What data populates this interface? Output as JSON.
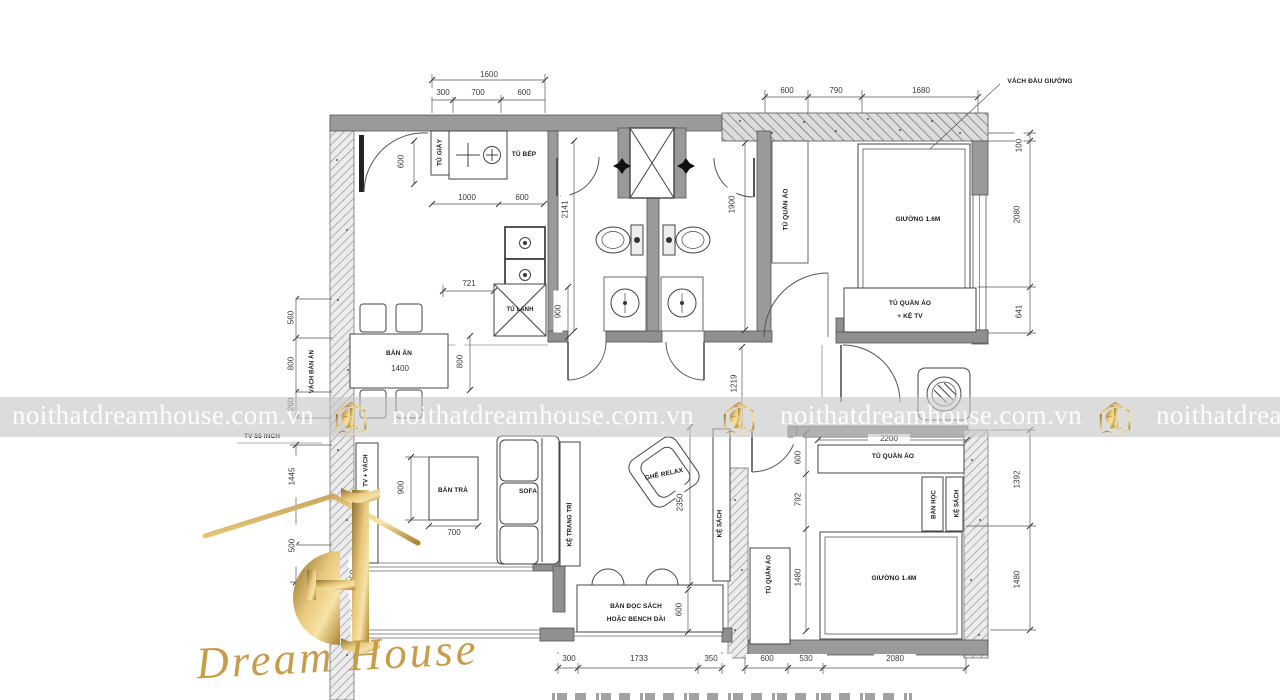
{
  "watermark": {
    "text": "noithatdreamhouse.com.vn",
    "text_partial": "noithatdrea"
  },
  "logo": {
    "title_script": "Dream House"
  },
  "labels": {
    "tu_giay": "TỦ GIÀY",
    "tu_bep": "TỦ BẾP",
    "tu_lanh": "TỦ LẠNH",
    "ban_an": "BÀN ĂN",
    "ban_an_size": "1400",
    "vach_ban_an": "VÁCH BÀN ĂN",
    "tu_quan_ao": "TỦ QUẦN ÁO",
    "giuong_16": "GIƯỜNG 1.6M",
    "vach_dau_giuong": "VÁCH ĐẦU GIƯỜNG",
    "tqa_ketv_line1": "TỦ QUẦN ÁO",
    "tqa_ketv_line2": "+ KỆ TV",
    "tv_55_inch": "TV 55 INCH",
    "tv_vach": "TV + VÁCH",
    "ban_tra": "BÀN TRÀ",
    "sofa": "SOFA",
    "ke_trang_tri": "KỆ TRANG TRÍ",
    "ghe_relax": "GHẾ RELAX",
    "ke_sach": "KỆ SÁCH",
    "ban_hoc": "BÀN HỌC",
    "giuong_14": "GIƯỜNG 1.4M",
    "ban_doc_sach_1": "BÀN ĐỌC SÁCH",
    "ban_doc_sach_2": "HOẶC BENCH DÀI"
  },
  "dims": {
    "top_total": "1600",
    "top_a": "300",
    "top_b": "700",
    "top_c": "600",
    "tr_a": "600",
    "tr_b": "790",
    "tr_c": "1680",
    "right_a": "100",
    "right_b": "2080",
    "right_c": "641",
    "right_d": "1392",
    "right_e": "1480",
    "kit_600v": "600",
    "kit_1000": "1000",
    "kit_600w": "600",
    "kit_2141": "2141",
    "kit_721": "721",
    "kit_900": "900",
    "kit_800": "800",
    "kit_1900": "1900",
    "left_560": "560",
    "left_800": "800",
    "left_260": "260",
    "left_1445": "1445",
    "left_500": "500",
    "left_250": "250",
    "left_400": "400",
    "liv_900": "900",
    "liv_700": "700",
    "liv_2350": "2350",
    "liv_1219": "1219",
    "liv_600": "600",
    "b2_2200": "2200",
    "b2_600": "600",
    "b2_792": "792",
    "b2_1480": "1480",
    "bot_300": "300",
    "bot_1733": "1733",
    "bot_350": "350",
    "bot_600": "600",
    "bot_530": "530",
    "bot_2080": "2080"
  }
}
